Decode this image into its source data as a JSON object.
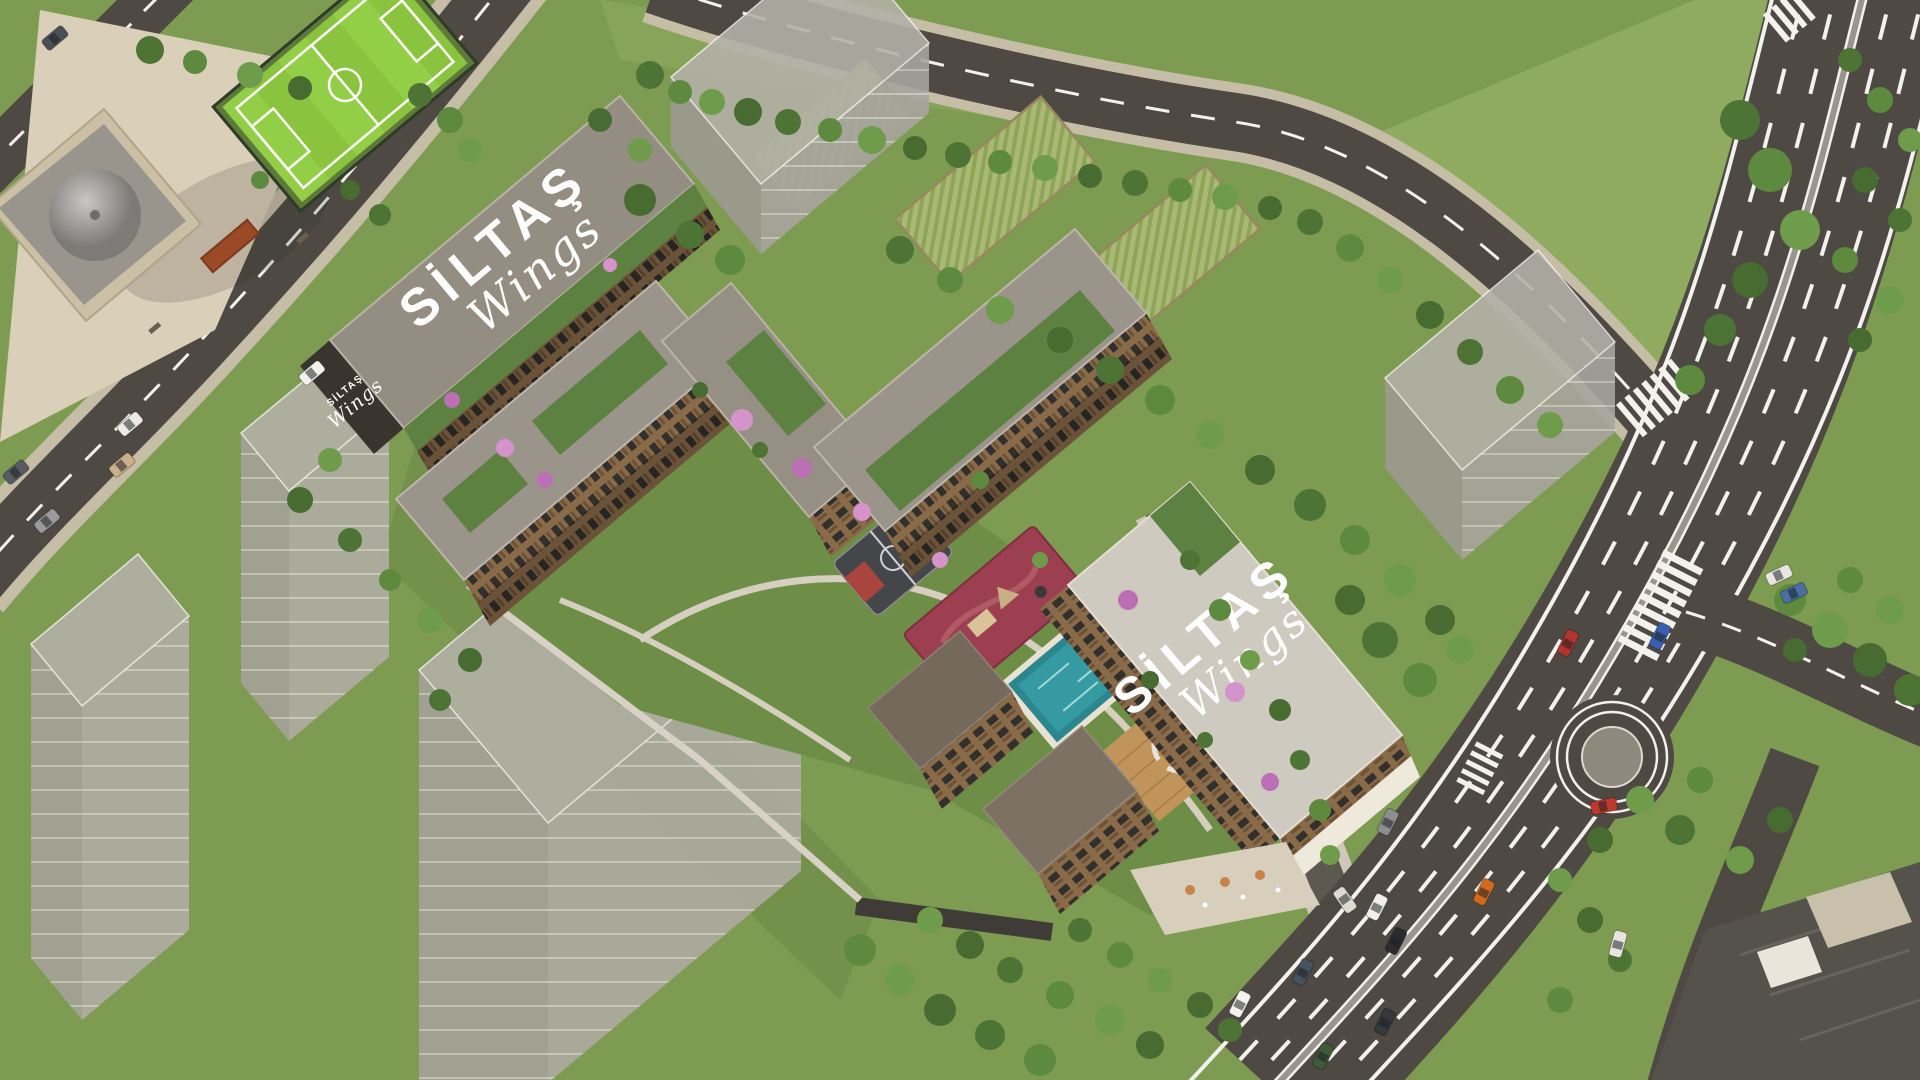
{
  "meta": {
    "title": "SILTAS Wings residential complex - aerial 3D render"
  },
  "branding": {
    "rooftop_sign_a": {
      "brand": "SİLTAŞ",
      "product": "Wings"
    },
    "rooftop_sign_b": {
      "brand": "SİLTAŞ",
      "product": "Wings"
    },
    "facade_sign": {
      "brand": "SİLTAŞ",
      "product": "Wings"
    }
  },
  "palette": {
    "grass": "#7e9b52",
    "grassLight": "#8fab60",
    "road": "#4e4943",
    "roadLine": "#f2f1ec",
    "sidewalk": "#c6bda6",
    "plaza": "#dacfb9",
    "mosqueWall": "#cbbfa5",
    "dome": "#a8a6a2",
    "pitch": "#8ac33e",
    "allotment": "#a9b975",
    "ghost": "#b3b0a8",
    "roofLight": "#cfcac0",
    "roofTaupe": "#948d82",
    "facade": "#8a6b49",
    "facadeDark": "#3a342e",
    "garden": "#5d8140",
    "pool": "#359aa1",
    "poolDeep": "#2c868e",
    "playground": "#9c3f50",
    "court": "#45464a",
    "courtKey": "#a8453f",
    "deck": "#c1945c",
    "treeGreen": "#55793a",
    "blossom": "#bb6fb4"
  },
  "cars": [
    {
      "color": "#b23430",
      "x": 1568,
      "y": 643,
      "angle": -63
    },
    {
      "color": "#3a5fae",
      "x": 1660,
      "y": 636,
      "angle": -63
    },
    {
      "color": "#c0392f",
      "x": 1604,
      "y": 806,
      "angle": -12
    },
    {
      "color": "#e8e6e2",
      "x": 1779,
      "y": 575,
      "angle": -25
    },
    {
      "color": "#4a6fa5",
      "x": 1794,
      "y": 593,
      "angle": -25
    },
    {
      "color": "#8e8e8e",
      "x": 1388,
      "y": 822,
      "angle": -63
    },
    {
      "color": "#f0efec",
      "x": 1377,
      "y": 907,
      "angle": -63
    },
    {
      "color": "#2c2c30",
      "x": 1396,
      "y": 941,
      "angle": -63
    },
    {
      "color": "#46525c",
      "x": 1303,
      "y": 972,
      "angle": -63
    },
    {
      "color": "#35383c",
      "x": 1385,
      "y": 1022,
      "angle": -63
    },
    {
      "color": "#3e5c3a",
      "x": 1323,
      "y": 1056,
      "angle": -63
    },
    {
      "color": "#d2691e",
      "x": 1484,
      "y": 892,
      "angle": -63
    },
    {
      "color": "#f4f3f0",
      "x": 1240,
      "y": 1004,
      "angle": -63
    },
    {
      "color": "#eceae6",
      "x": 130,
      "y": 424,
      "angle": -40
    },
    {
      "color": "#c9b089",
      "x": 122,
      "y": 465,
      "angle": -40
    },
    {
      "color": "#9a9a9a",
      "x": 47,
      "y": 521,
      "angle": -40
    },
    {
      "color": "#585c60",
      "x": 16,
      "y": 472,
      "angle": -40
    },
    {
      "color": "#f2f1ee",
      "x": 312,
      "y": 373,
      "angle": -40
    },
    {
      "color": "#4b4f54",
      "x": 55,
      "y": 38,
      "angle": -40
    },
    {
      "color": "#e8e5df",
      "x": 1618,
      "y": 944,
      "angle": -75
    },
    {
      "color": "#dddad2",
      "x": 1345,
      "y": 900,
      "angle": 55
    }
  ]
}
